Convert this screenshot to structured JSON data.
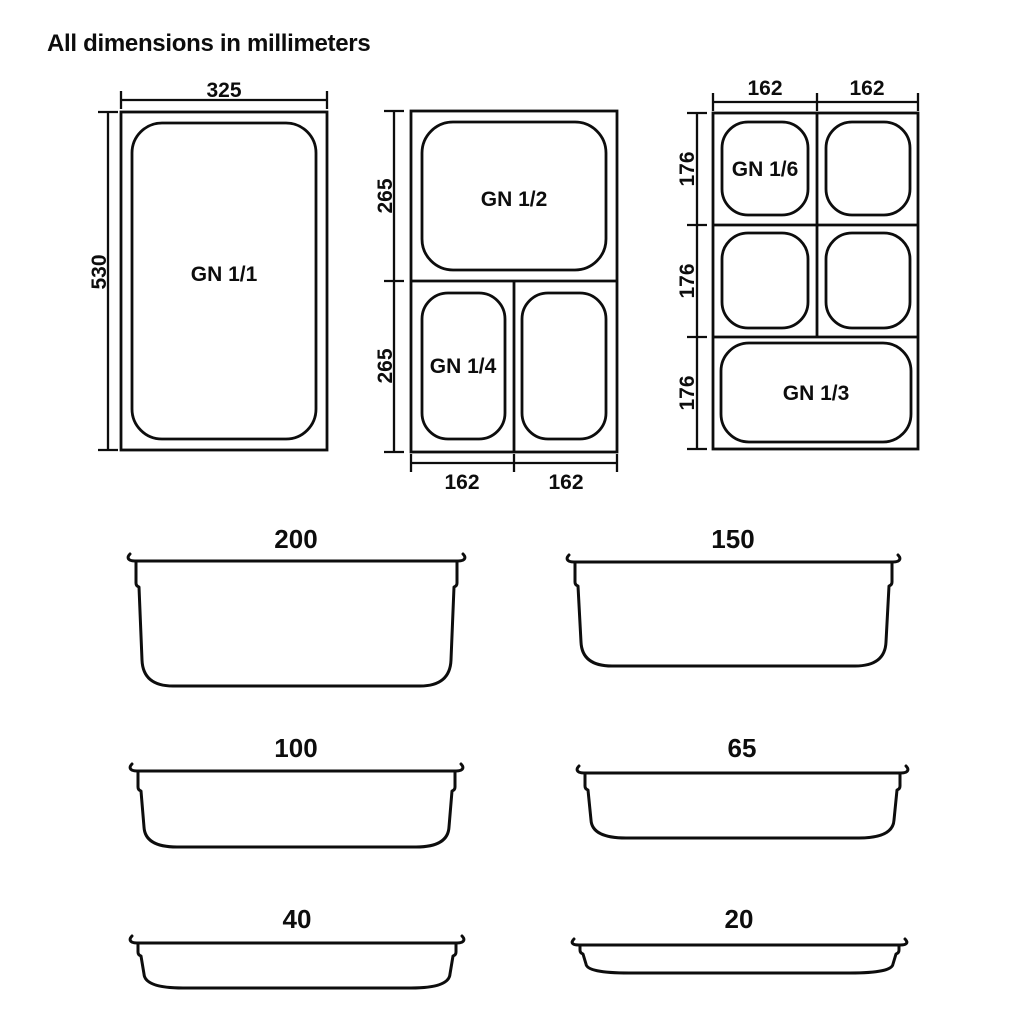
{
  "title": "All dimensions in millimeters",
  "plan_views": {
    "gn_1_1": {
      "label": "GN 1/1",
      "width_mm": "325",
      "height_mm": "530"
    },
    "gn_halves": {
      "gn_1_2_label": "GN 1/2",
      "gn_1_4_label": "GN 1/4",
      "upper_height_mm": "265",
      "lower_height_mm": "265",
      "bottom_left_width_mm": "162",
      "bottom_right_width_mm": "162"
    },
    "gn_thirds": {
      "gn_1_6_label": "GN 1/6",
      "gn_1_3_label": "GN 1/3",
      "top_left_width_mm": "162",
      "top_right_width_mm": "162",
      "row1_height_mm": "176",
      "row2_height_mm": "176",
      "row3_height_mm": "176"
    }
  },
  "profiles": [
    {
      "depth_mm": "200"
    },
    {
      "depth_mm": "150"
    },
    {
      "depth_mm": "100"
    },
    {
      "depth_mm": "65"
    },
    {
      "depth_mm": "40"
    },
    {
      "depth_mm": "20"
    }
  ]
}
